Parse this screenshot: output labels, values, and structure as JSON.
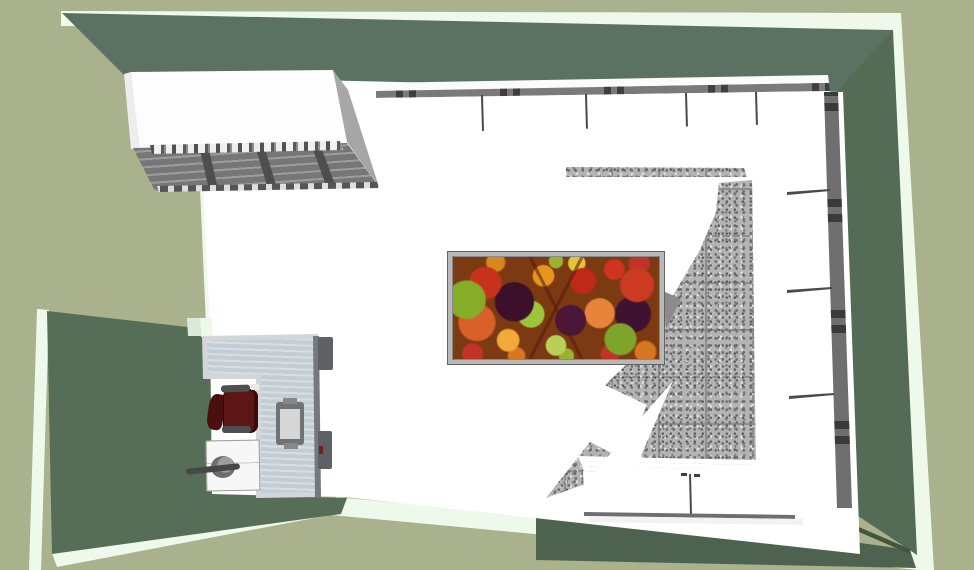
{
  "scene": {
    "type": "3d-room-top-view-render",
    "description_objects": [
      {
        "name": "room-walls",
        "parts": [
          "top-wall",
          "right-wall",
          "left-wall",
          "bottom-wall"
        ]
      },
      {
        "name": "wall-top-bands"
      },
      {
        "name": "floor"
      },
      {
        "name": "wall-cabinet-top-left",
        "parts": [
          "top-face",
          "side-face",
          "vent-grille"
        ]
      },
      {
        "name": "upper-cabinet-run-top",
        "doors": 4
      },
      {
        "name": "cabinet-run-right",
        "doors": 4
      },
      {
        "name": "base-cabinet-run-bottom",
        "doors": 2
      },
      {
        "name": "granite-counter-tiles"
      },
      {
        "name": "fruit-print-table"
      },
      {
        "name": "l-shaped-desk"
      },
      {
        "name": "office-chair-maroon"
      },
      {
        "name": "visitor-chair-gray"
      },
      {
        "name": "drawer-unit"
      },
      {
        "name": "desk-lamp"
      },
      {
        "name": "computer-tower"
      }
    ]
  },
  "colors": {
    "sage": "#a9b28c",
    "pale_band": "#eef9ec",
    "wall_top": "#5b7263",
    "wall_right": "#546b56",
    "wall_left": "#566e58",
    "wall_bottom": "#4e634f",
    "wall_shade": "#43543f",
    "floor": "#ffffff",
    "cabinet": "#ffffff",
    "rail": "#7a7a7a",
    "divider": "#4a4a4a",
    "grille": "#767676",
    "grille_dark": "#4e4e4e",
    "counter": "#b3b3b3",
    "grout": "#8d8d8d",
    "frame_silver": "#b8b8b8",
    "desk_frame": "#d3d6d8",
    "desk_top": "#c3cdd3",
    "chair": "#5e1515",
    "chair_dark": "#4a1010",
    "arm": "#4d4f51",
    "visitor_seat": "#d6d6d6",
    "visitor_frame": "#6f7376",
    "unit": "#f7f7f7",
    "tower": "#5d6165"
  }
}
